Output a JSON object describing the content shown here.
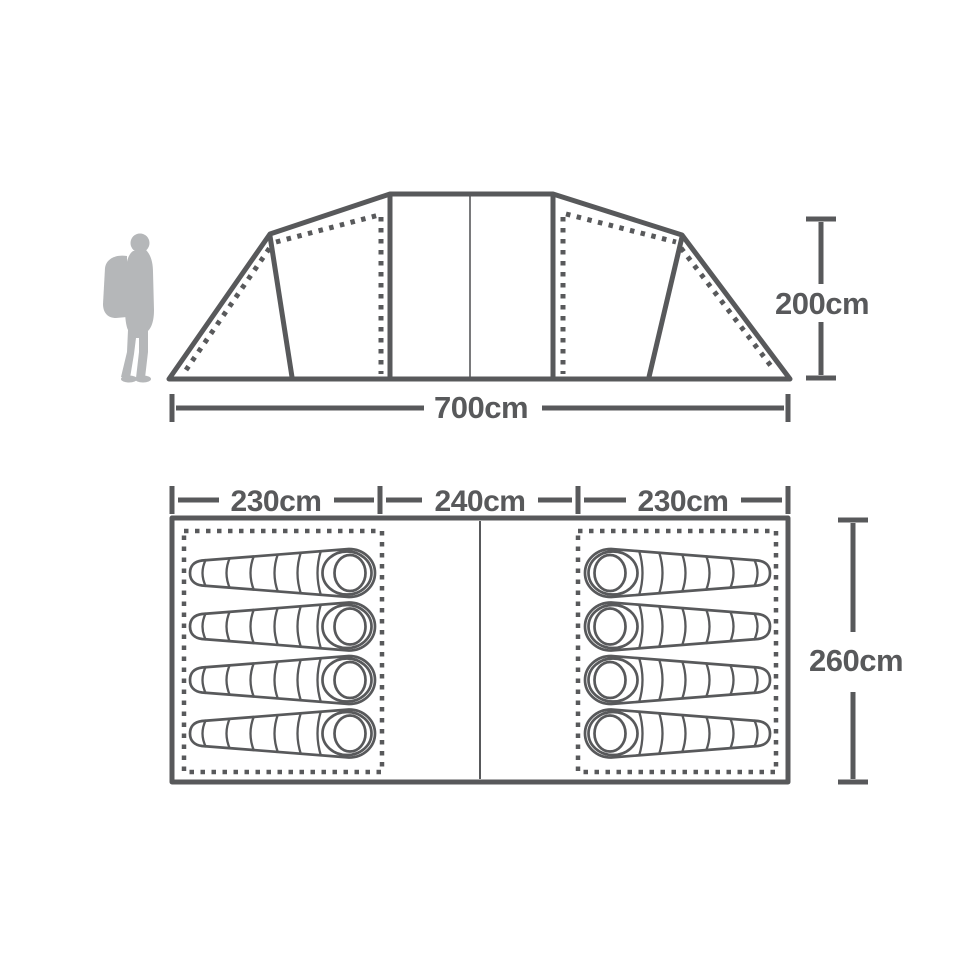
{
  "diagram": {
    "kind": "tent-dimension-spec",
    "colors": {
      "line": "#58595b",
      "silhouette": "#b5b7b9",
      "background": "#ffffff"
    },
    "side_view": {
      "width_label": "700cm",
      "height_label": "200cm",
      "person_icon": "hiker-silhouette-icon"
    },
    "floor_plan": {
      "section_labels": [
        "230cm",
        "240cm",
        "230cm"
      ],
      "depth_label": "260cm",
      "rooms": [
        {
          "id": "left-bedroom",
          "sleeping_bags": 4,
          "head_side": "right"
        },
        {
          "id": "right-bedroom",
          "sleeping_bags": 4,
          "head_side": "left"
        }
      ]
    }
  }
}
